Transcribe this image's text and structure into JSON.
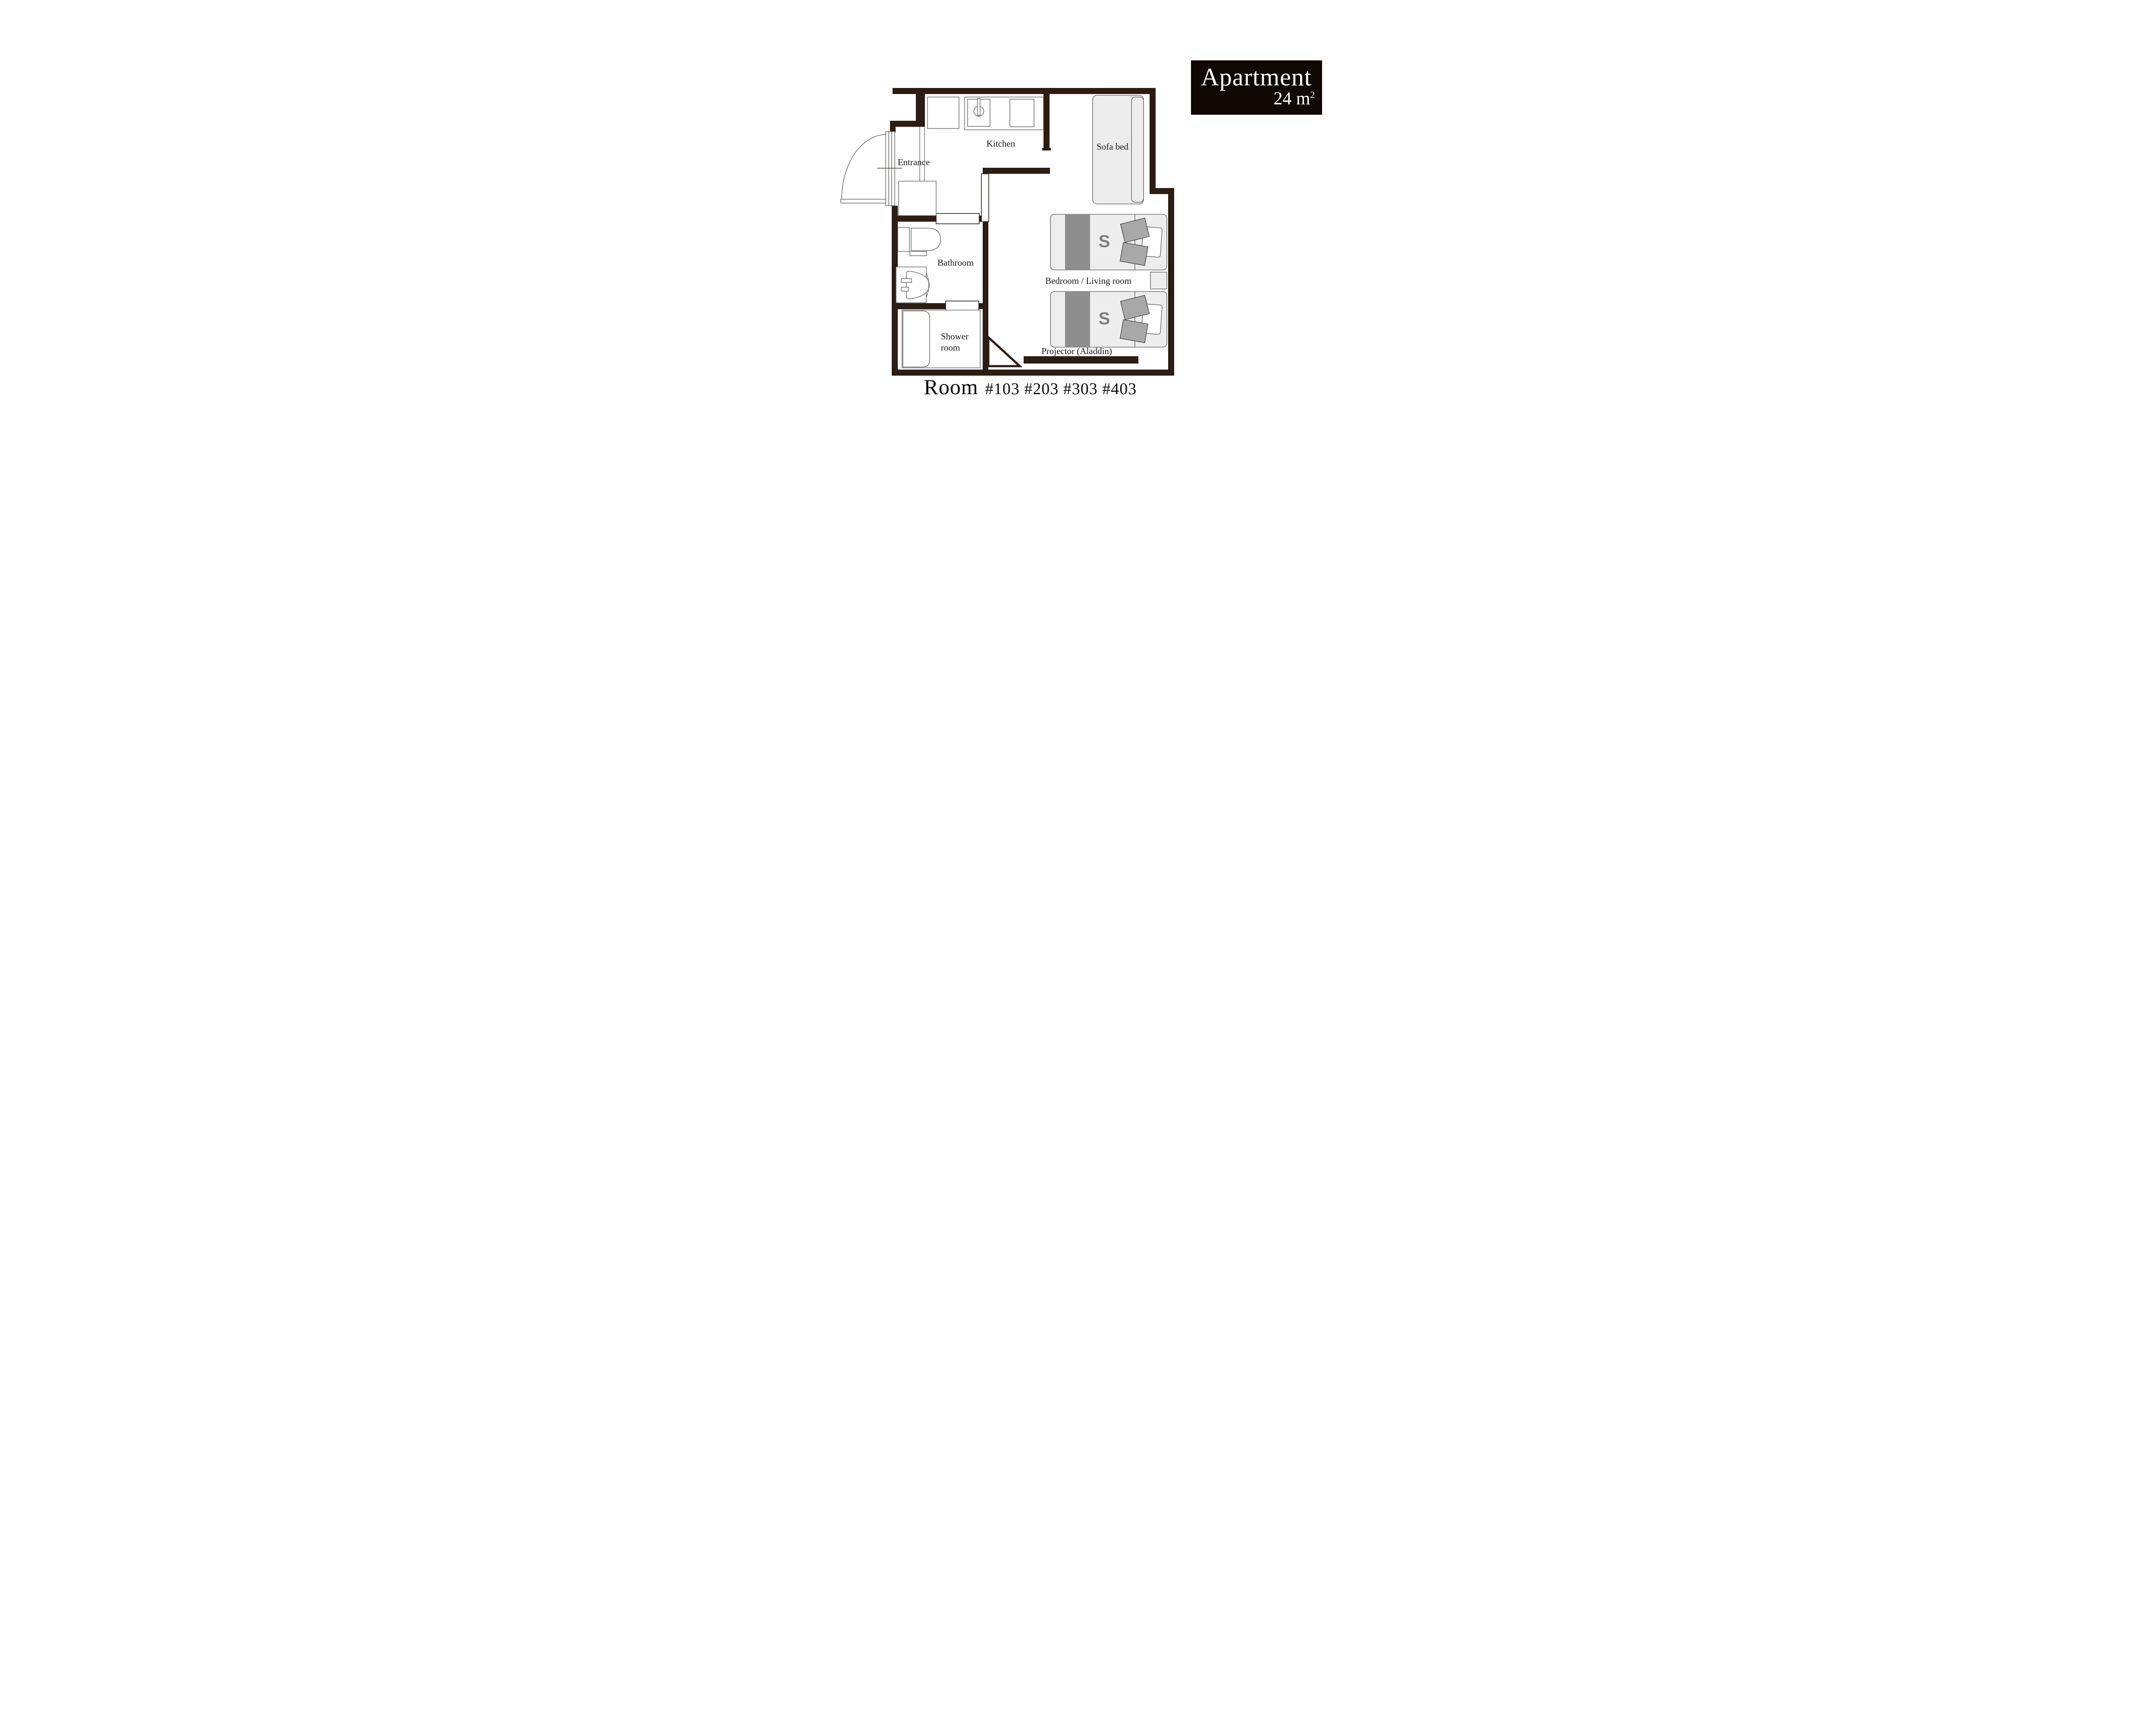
{
  "title_card": {
    "name": "Apartment",
    "area_value": "24 m",
    "area_exponent": "2"
  },
  "plan": {
    "labels": {
      "kitchen": "Kitchen",
      "entrance": "Entrance",
      "bathroom": "Bathroom",
      "shower_line1": "Shower",
      "shower_line2": "room",
      "sofa_bed": "Sofa bed",
      "bedroom_living": "Bedroom / Living room",
      "projector": "Projector (Aladdin)",
      "bed_single_mark": "S"
    }
  },
  "footer": {
    "room_label": "Room",
    "room_numbers": "#103 #203 #303 #403"
  },
  "colors": {
    "wall": "#2b1c14",
    "fixture_outline": "#595757",
    "furniture_fill": "#ededed",
    "duvet_band": "#8e8e8e",
    "pillow_gray": "#a8a8a8",
    "bed_mark": "#7d7d7d",
    "title_bg": "#0e0704",
    "title_text": "#ffffff"
  }
}
